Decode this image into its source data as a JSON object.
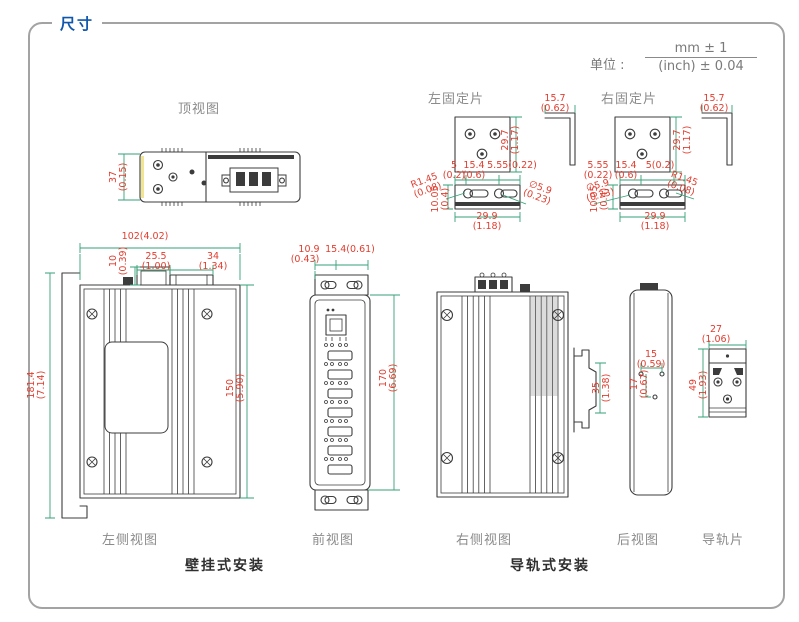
{
  "title": "尺寸",
  "unit": {
    "label": "单位 :",
    "mm": "mm ± 1",
    "inch": "(inch) ± 0.04"
  },
  "captions": {
    "top_view": "顶视图",
    "left_plate": "左固定片",
    "right_plate": "右固定片",
    "left_side_view": "左侧视图",
    "front_view": "前视图",
    "right_side_view": "右侧视图",
    "rear_view": "后视图",
    "rail_plate": "导轨片",
    "wall_mount": "壁挂式安装",
    "din_mount": "导轨式安装"
  },
  "dims": {
    "top_view_h": {
      "mm": "37",
      "in": "(0.15)"
    },
    "plate_h": {
      "mm": "29.7",
      "in": "(1.17)"
    },
    "plate_side_w": {
      "mm": "15.7",
      "in": "(0.62)"
    },
    "lp_5": {
      "mm": "5",
      "in": "(0.2)"
    },
    "lp_154": {
      "mm": "15.4",
      "in": "(0.6)"
    },
    "lp_555": {
      "mm": "5.55(0.22)"
    },
    "lp_r": {
      "mm": "R1.45",
      "in": "(0.08)"
    },
    "lp_d": {
      "mm": "∅5.9",
      "in": "(0.23)"
    },
    "lp_1005": {
      "mm": "10.05",
      "in": "(0.4)"
    },
    "lp_299": {
      "mm": "29.9",
      "in": "(1.18)"
    },
    "rp_555": {
      "mm": "5.55",
      "in": "(0.22)"
    },
    "rp_154": {
      "mm": "15.4",
      "in": "(0.6)"
    },
    "rp_5": {
      "mm": "5(0.2)"
    },
    "rp_r": {
      "mm": "R1.45",
      "in": "(0.08)"
    },
    "rp_d": {
      "mm": "∅5.9",
      "in": "(0.23)"
    },
    "rp_1005": {
      "mm": "10.05",
      "in": "(0.4)"
    },
    "rp_299": {
      "mm": "29.9",
      "in": "(1.18)"
    },
    "ls_102": {
      "mm": "102(4.02)"
    },
    "ls_10": {
      "mm": "10",
      "in": "(0.39)"
    },
    "ls_255": {
      "mm": "25.5",
      "in": "(1.00)"
    },
    "ls_34": {
      "mm": "34",
      "in": "(1.34)"
    },
    "ls_1814": {
      "mm": "181.4",
      "in": "(7.14)"
    },
    "ls_150": {
      "mm": "150",
      "in": "(5.90)"
    },
    "fv_109": {
      "mm": "10.9",
      "in": "(0.43)"
    },
    "fv_154": {
      "mm": "15.4(0.61)"
    },
    "fv_170": {
      "mm": "170",
      "in": "(6.69)"
    },
    "rs_35": {
      "mm": "35",
      "in": "(1.38)"
    },
    "rv_15": {
      "mm": "15",
      "in": "(0.59)"
    },
    "rv_17": {
      "mm": "17",
      "in": "(0.67)"
    },
    "dr_27": {
      "mm": "27",
      "in": "(1.06)"
    },
    "dr_49": {
      "mm": "49",
      "in": "(1.93)"
    }
  },
  "colors": {
    "title_blue": "#0e57ad",
    "dim_line_green": "#35a277",
    "dim_text_red": "#e23c2e",
    "drawing_line": "#3c3c3c",
    "caption_gray": "#8b8b8b"
  }
}
